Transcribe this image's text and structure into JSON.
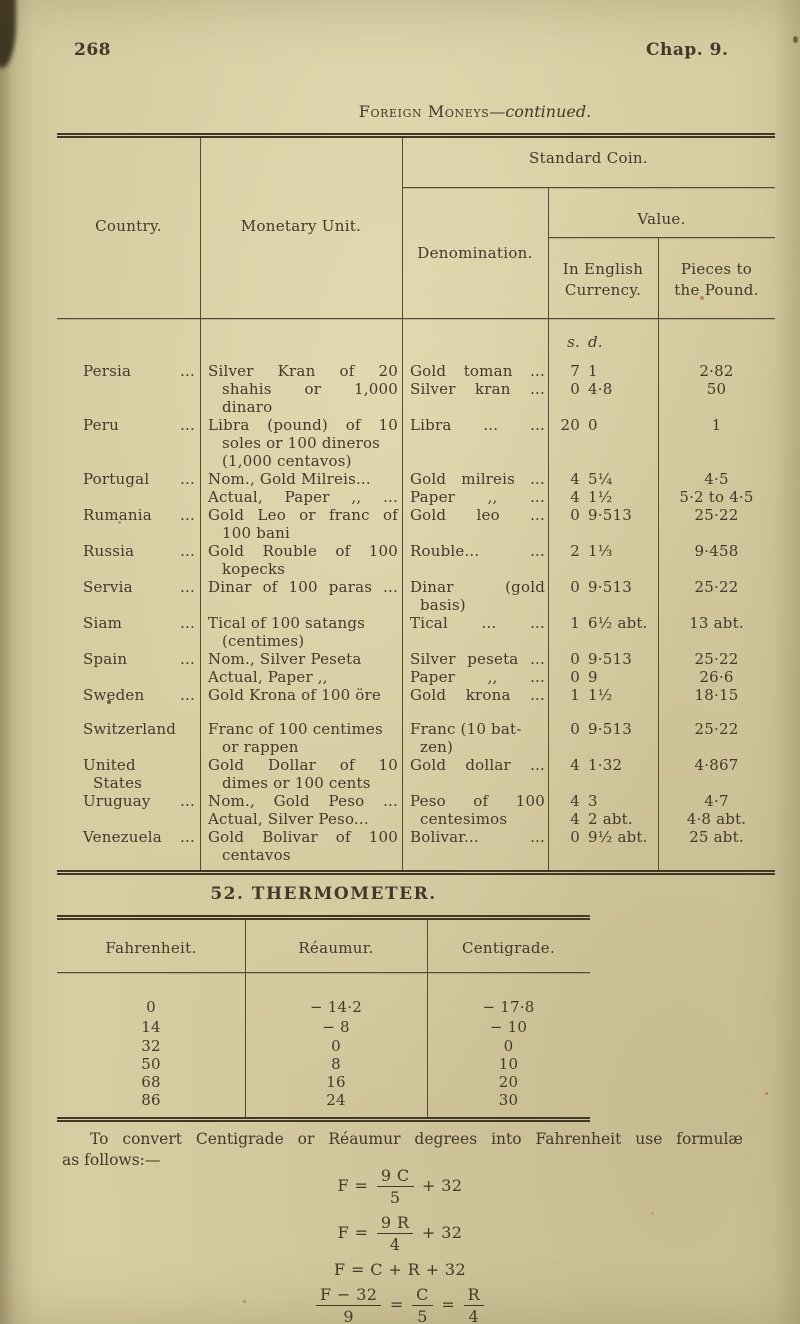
{
  "header": {
    "page_number": "268",
    "chapter": "Chap. 9."
  },
  "money_table": {
    "caption_small_caps": "Foreign Moneys",
    "caption_italic": "—continued.",
    "columns": {
      "country": "Country.",
      "monetary_unit": "Monetary Unit.",
      "standard_coin": "Standard Coin.",
      "denomination": "Denomination.",
      "value": "Value.",
      "in_english_1": "In English",
      "in_english_2": "Currency.",
      "pieces_1": "Pieces to",
      "pieces_2": "the Pound."
    },
    "sd_header": {
      "s": "s.",
      "d": "d."
    },
    "rows": [
      {
        "country": [
          "Persia"
        ],
        "dots": true,
        "unit": [
          {
            "t": "Silver Kran of 20",
            "justify": true
          },
          {
            "t": "shahis or 1,000",
            "justify": true,
            "indent": true
          },
          {
            "t": "dinaro",
            "indent": true
          }
        ],
        "denom": [
          {
            "t": "Gold toman ...",
            "justify": true
          },
          {
            "t": "Silver kran ...",
            "justify": true
          }
        ],
        "vals": [
          {
            "s": "7",
            "d": "1",
            "p": "2·82"
          },
          {
            "s": "0",
            "d": "4·8",
            "p": "50"
          }
        ]
      },
      {
        "country": [
          "Peru"
        ],
        "dots": true,
        "unit": [
          {
            "t": "Libra (pound) of 10",
            "justify": true
          },
          {
            "t": "soles or 100 dineros",
            "indent": true
          },
          {
            "t": "(1,000 centavos)",
            "indent": true
          }
        ],
        "denom": [
          {
            "t": "Libra ... ...",
            "justify": true
          }
        ],
        "vals": [
          {
            "s": "20",
            "d": "0",
            "p": "1"
          }
        ]
      },
      {
        "country": [
          "Portugal"
        ],
        "dots": true,
        "unit": [
          {
            "t": "Nom., Gold Milreis..."
          },
          {
            "t": "Actual, Paper ,, ...",
            "justify": true
          }
        ],
        "denom": [
          {
            "t": "Gold milreis ...",
            "justify": true
          },
          {
            "t": "Paper ,, ...",
            "justify": true
          }
        ],
        "vals": [
          {
            "s": "4",
            "d": "5¼",
            "p": "4·5"
          },
          {
            "s": "4",
            "d": "1½",
            "p": "5·2 to 4·5"
          }
        ]
      },
      {
        "country": [
          "Rumania"
        ],
        "dots": true,
        "unit": [
          {
            "t": "Gold Leo or franc of",
            "justify": true
          },
          {
            "t": "100 bani",
            "indent": true
          }
        ],
        "denom": [
          {
            "t": "Gold leo ...",
            "justify": true
          }
        ],
        "vals": [
          {
            "s": "0",
            "d": "9·513",
            "p": "25·22"
          }
        ]
      },
      {
        "country": [
          "Russia"
        ],
        "dots": true,
        "unit": [
          {
            "t": "Gold Rouble of 100",
            "justify": true
          },
          {
            "t": "kopecks",
            "indent": true
          }
        ],
        "denom": [
          {
            "t": "Rouble... ...",
            "justify": true
          }
        ],
        "vals": [
          {
            "s": "2",
            "d": "1⅓",
            "p": "9·458"
          }
        ]
      },
      {
        "country": [
          "Servia"
        ],
        "dots": true,
        "unit": [
          {
            "t": "Dinar of 100 paras ...",
            "justify": true
          }
        ],
        "denom": [
          {
            "t": "Dinar (gold",
            "justify": true
          },
          {
            "t": "basis)",
            "indent": true
          }
        ],
        "vals": [
          {
            "s": "0",
            "d": "9·513",
            "p": "25·22"
          }
        ]
      },
      {
        "country": [
          "Siam"
        ],
        "dots": true,
        "unit": [
          {
            "t": "Tical of 100 satangs"
          },
          {
            "t": "(centimes)",
            "indent": true
          }
        ],
        "denom": [
          {
            "t": "Tical ... ...",
            "justify": true
          }
        ],
        "vals": [
          {
            "s": "1",
            "d": "6½ abt.",
            "p": "13 abt."
          }
        ]
      },
      {
        "country": [
          "Spain"
        ],
        "dots": true,
        "unit": [
          {
            "t": "Nom., Silver Peseta"
          },
          {
            "t": "Actual, Paper ,,"
          }
        ],
        "denom": [
          {
            "t": "Silver peseta ...",
            "justify": true
          },
          {
            "t": "Paper ,, ...",
            "justify": true
          }
        ],
        "vals": [
          {
            "s": "0",
            "d": "9·513",
            "p": "25·22"
          },
          {
            "s": "0",
            "d": "9",
            "p": "26·6"
          }
        ]
      },
      {
        "country": [
          "Sweden"
        ],
        "dots": true,
        "gap_after": 16,
        "unit": [
          {
            "t": "Gold Krona of 100 öre"
          }
        ],
        "denom": [
          {
            "t": "Gold krona ...",
            "justify": true
          }
        ],
        "vals": [
          {
            "s": "1",
            "d": "1½",
            "p": "18·15"
          }
        ]
      },
      {
        "country": [
          "Switzerland"
        ],
        "unit": [
          {
            "t": "Franc of 100 centimes"
          },
          {
            "t": "or rappen",
            "indent": true
          }
        ],
        "denom": [
          {
            "t": "Franc (10 bat-"
          },
          {
            "t": "zen)",
            "indent": true
          }
        ],
        "vals": [
          {
            "s": "0",
            "d": "9·513",
            "p": "25·22"
          }
        ]
      },
      {
        "country": [
          "United",
          "States"
        ],
        "unit": [
          {
            "t": "Gold Dollar of 10",
            "justify": true
          },
          {
            "t": "dimes or 100 cents",
            "indent": true
          }
        ],
        "denom": [
          {
            "t": "Gold dollar ...",
            "justify": true
          }
        ],
        "vals": [
          {
            "s": "4",
            "d": "1·32",
            "p": "4·867"
          }
        ]
      },
      {
        "country": [
          "Uruguay"
        ],
        "dots": true,
        "unit": [
          {
            "t": "Nom., Gold Peso ...",
            "justify": true
          },
          {
            "t": "Actual, Silver Peso..."
          }
        ],
        "denom": [
          {
            "t": "Peso of 100",
            "justify": true
          },
          {
            "t": "centesimos",
            "indent": true
          }
        ],
        "vals": [
          {
            "s": "4",
            "d": "3",
            "p": "4·7"
          },
          {
            "s": "4",
            "d": "2 abt.",
            "p": "4·8 abt."
          }
        ]
      },
      {
        "country": [
          "Venezuela"
        ],
        "dots": true,
        "unit": [
          {
            "t": "Gold Bolivar of 100",
            "justify": true
          },
          {
            "t": "centavos",
            "indent": true
          }
        ],
        "denom": [
          {
            "t": "Bolivar... ...",
            "justify": true
          }
        ],
        "vals": [
          {
            "s": "0",
            "d": "9½ abt.",
            "p": "25 abt."
          }
        ]
      }
    ]
  },
  "thermometer": {
    "section_heading": "52. THERMOMETER.",
    "columns": [
      "Fahrenheit.",
      "Réaumur.",
      "Centigrade."
    ],
    "rows": [
      [
        "0",
        "− 14·2",
        "− 17·8"
      ],
      [
        "14",
        "− 8",
        "− 10"
      ],
      [
        "32",
        "0",
        "0"
      ],
      [
        "50",
        "8",
        "10"
      ],
      [
        "68",
        "16",
        "20"
      ],
      [
        "86",
        "24",
        "30"
      ]
    ]
  },
  "conversion": {
    "line1": "To convert Centigrade or Réaumur degrees into Fahrenheit use formulæ",
    "line2": "as follows:—",
    "formulas": [
      {
        "type": "frac",
        "pre": "F =",
        "num": "9 C",
        "den": "5",
        "post": "+ 32"
      },
      {
        "type": "frac",
        "pre": "F =",
        "num": "9 R",
        "den": "4",
        "post": "+ 32"
      },
      {
        "type": "plain",
        "text": "F = C + R + 32"
      },
      {
        "type": "multi",
        "sep": "=",
        "parts": [
          {
            "num": "F − 32",
            "den": "9"
          },
          {
            "num": "C",
            "den": "5"
          },
          {
            "num": "R",
            "den": "4"
          }
        ]
      }
    ]
  },
  "colors": {
    "paper": "#d7cda2",
    "ink": "#43392a",
    "rule": "#564a37"
  }
}
